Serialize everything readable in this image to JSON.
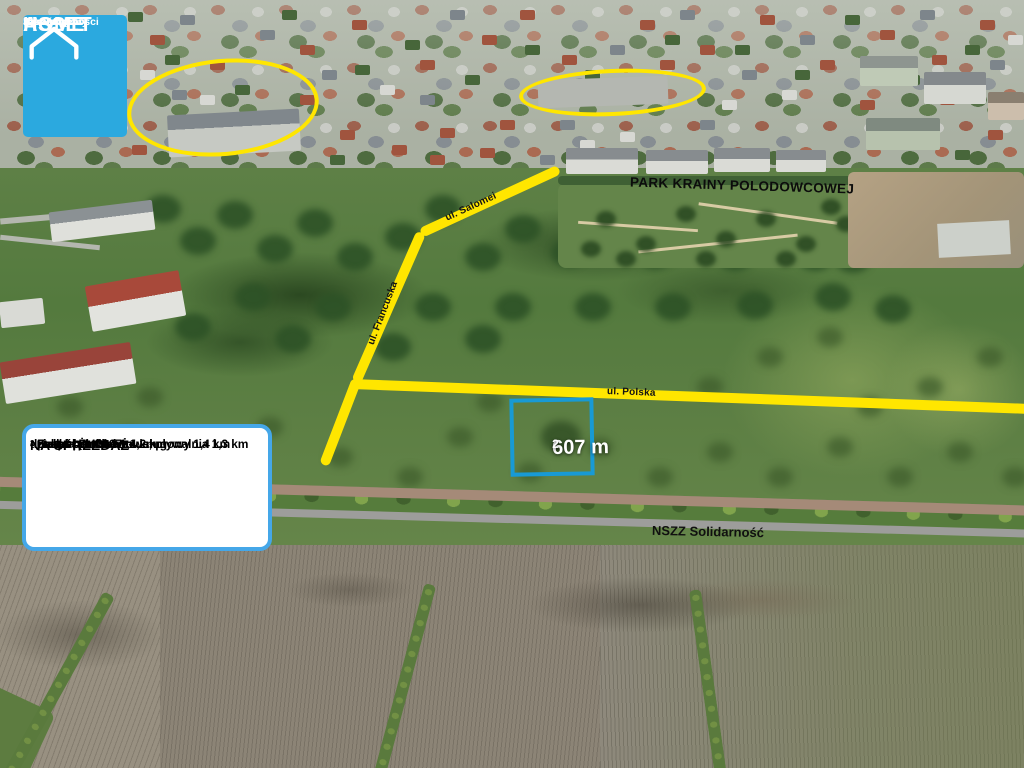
{
  "logo": {
    "line1": "HOME",
    "line2": "ASSET",
    "tagline1": "Nieruchomości",
    "tagline2": "Sprzedajemy",
    "tagline3": "Jakością",
    "bg_color": "#2BA9DF"
  },
  "labels": {
    "park": "PARK KRAINY POLODOWCOWEJ",
    "road_salomei": "ul. Salomei",
    "road_francuska": "ul. Francuska",
    "road_polska": "ul. Polska",
    "street_main": "NSZZ Solidarność"
  },
  "plot": {
    "area_value": "607 m",
    "area_sup": "2",
    "outline_color": "#189AD5"
  },
  "info_box": {
    "title": "NA SPRZEDAŻ",
    "area_line": "działka pow. 607 m",
    "area_sup": "2",
    "features": [
      "- Szkoła podstawowa, pływalnia 1,3 km",
      "- Zespół Żłobków 1,2 km",
      "- market \"LIDL\" 1,4 km",
      "- pasaż handlowo- usługowy 1,4 km"
    ],
    "border_color": "#45A7E8"
  },
  "highlight": {
    "color": "#FFE600"
  }
}
